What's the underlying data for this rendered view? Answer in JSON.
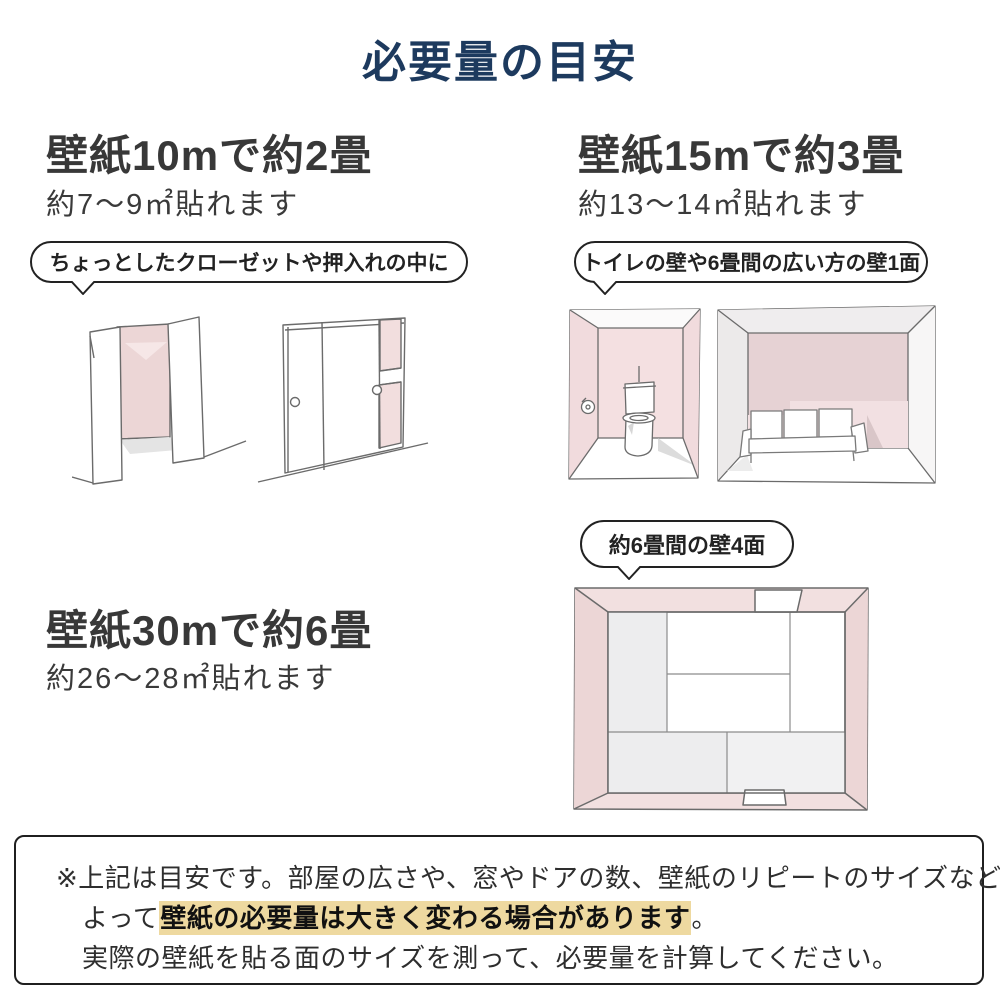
{
  "title": "必要量の目安",
  "sections": {
    "ten": {
      "heading": "壁紙10mで約2畳",
      "sub": "約7〜9㎡貼れます",
      "bubble": "ちょっとしたクローゼットや押入れの中に"
    },
    "fifteen": {
      "heading": "壁紙15mで約3畳",
      "sub": "約13〜14㎡貼れます",
      "bubble": "トイレの壁や6畳間の広い方の壁1面",
      "bubble_four_walls": "約6畳間の壁4面"
    },
    "thirty": {
      "heading": "壁紙30mで約6畳",
      "sub": "約26〜28㎡貼れます"
    }
  },
  "notice": {
    "line1": "※上記は目安です。部屋の広さや、窓やドアの数、壁紙のリピートのサイズなどに",
    "line2_prefix": "よって",
    "line2_highlight": "壁紙の必要量は大きく変わる場合があります",
    "line2_suffix": "。",
    "line3": "実際の壁紙を貼る面のサイズを測って、必要量を計算してください。"
  },
  "illustrations": {
    "closet_open": "open-closet-sketch",
    "closet_sliding": "sliding-door-closet-sketch",
    "toilet_room": "toilet-room-sketch",
    "sofa_room": "six-tatami-wide-wall-sketch",
    "tatami_room": "six-tatami-room-top-view-sketch"
  },
  "colors": {
    "title_navy": "#1d3a5e",
    "text_dark": "#383838",
    "wall_pink": "#f2dede",
    "wall_pink_dark": "#e6d2d4",
    "highlight_yellow": "#eed9a0",
    "sketch_line": "#6b6b6b"
  }
}
